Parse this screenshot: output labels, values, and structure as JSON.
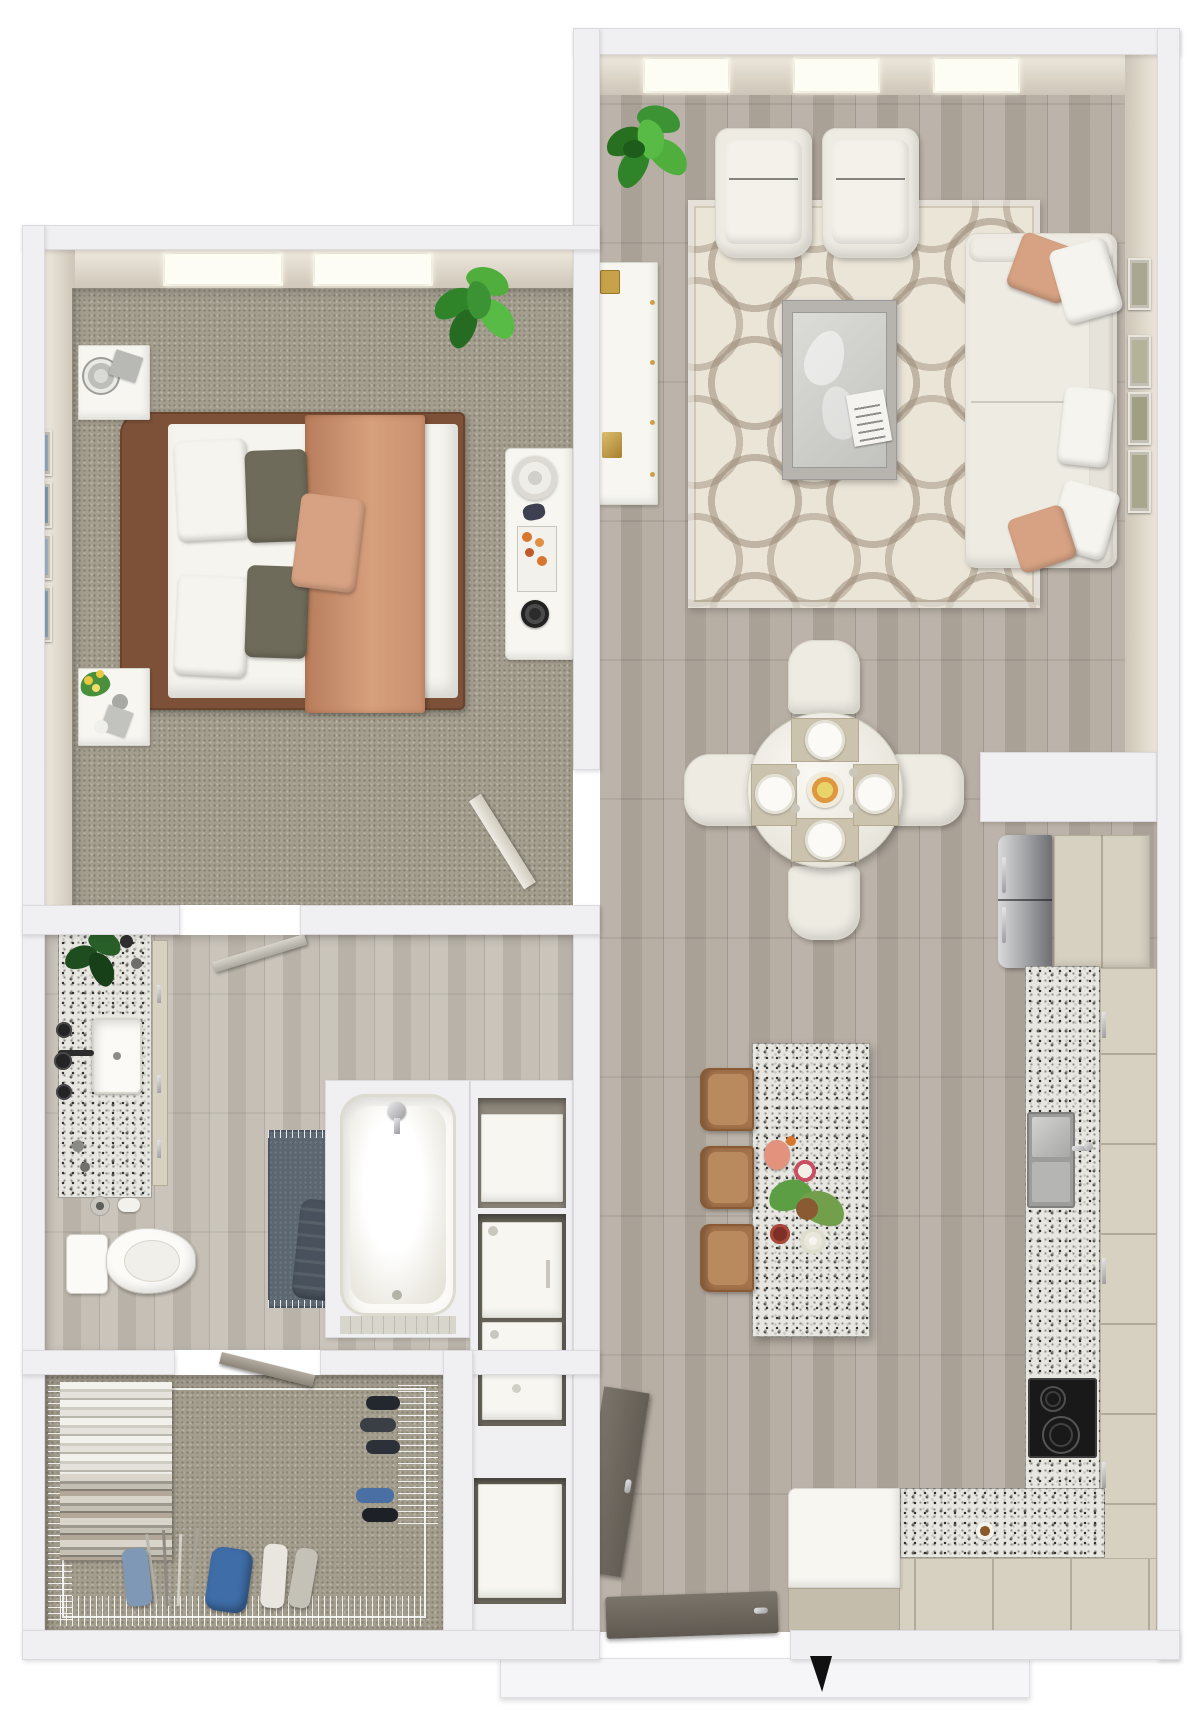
{
  "scene": {
    "kind": "3d-rendered-floor-plan-top-view",
    "description": "one-bedroom apartment furnished 3D plan, no text labels visible"
  },
  "palette": {
    "wall": "#f0eff1",
    "wallEdge": "#dcdade",
    "faceDark": "#cdc5b7",
    "carpet": "#a49e8f",
    "woodA": "#b4aba0",
    "bathWoodA": "#c2bcb1",
    "rug": "#ebe5d8",
    "rugRing": "#a2968a",
    "white": "#f7f6f1",
    "furnWhite": "#edebe2",
    "peach": "#d7a283",
    "bedFrame": "#7c5137",
    "blanket": "#c9906f",
    "olive": "#6f6b5a",
    "granite": "#e8e6e1",
    "beigeCab": "#d7d1c2",
    "beigeCabDark": "#c4bdac",
    "stainless": "#aeaeb0",
    "cooktop": "#191919",
    "taupeDoor": "#6f6962",
    "slate": "#5b6671",
    "green": "#3b9334",
    "greenDark": "#27701f",
    "gold": "#c8a24b",
    "artBlue": "#93a9bc",
    "artMoss": "#a9a78f",
    "bagBlue": "#3f6da8"
  },
  "rooms": [
    {
      "name": "living-room",
      "furniture": [
        "potted-plant",
        "media-console",
        "armchair-left",
        "armchair-right",
        "area-rug",
        "coffee-table",
        "magazine",
        "sofa",
        "throw-pillows",
        "wall-art-column",
        "ceiling-light-panels"
      ]
    },
    {
      "name": "dining-area",
      "furniture": [
        "round-table",
        "four-upholstered-chairs",
        "four-place-settings",
        "fruit-centerpiece"
      ]
    },
    {
      "name": "kitchen",
      "furniture": [
        "refrigerator",
        "pantry-cabinet",
        "granite-counter-right",
        "granite-counter-bottom",
        "sink",
        "faucet",
        "cooktop",
        "island",
        "three-bar-stools",
        "island-centerpiece",
        "coffee-cup",
        "peninsula-block",
        "base-cabinets"
      ]
    },
    {
      "name": "bedroom",
      "furniture": [
        "bed",
        "wood-headboard",
        "white-duvet",
        "salmon-throw-blanket",
        "pillows",
        "nightstand-top",
        "table-lamp",
        "nightstand-bottom",
        "flower-bouquet",
        "dresser",
        "dresser-decor",
        "potted-plant",
        "wall-art-frames",
        "two-windows"
      ]
    },
    {
      "name": "bathroom",
      "furniture": [
        "granite-vanity",
        "vessel-sink",
        "black-faucet",
        "wall-knobs",
        "monstera-plant",
        "toilet",
        "toilet-paper-holder",
        "bath-mat",
        "towel",
        "bathtub",
        "shower-fixture",
        "door-leaf"
      ]
    },
    {
      "name": "walk-in-closet",
      "furniture": [
        "wire-shelving",
        "hanging-clothes",
        "folded-stacks",
        "shoe-rows",
        "golf-bag",
        "golf-clubs",
        "door-leaf"
      ]
    },
    {
      "name": "laundry-column",
      "furniture": [
        "linen-shelf-box",
        "washer",
        "dryer",
        "storage-cabinet"
      ]
    },
    {
      "name": "entry",
      "furniture": [
        "entry-door-leaf",
        "open-door-leaf",
        "door-stop-wedge",
        "threshold-platform"
      ]
    }
  ]
}
